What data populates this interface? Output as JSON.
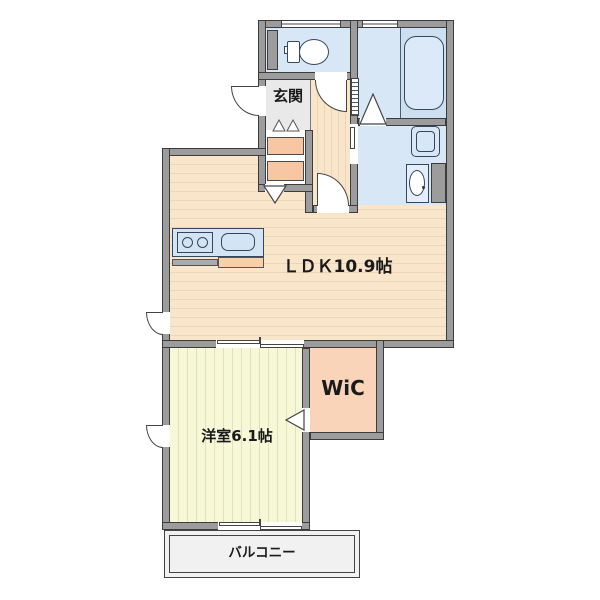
{
  "plan": {
    "type": "apartment-floor-plan",
    "labels": {
      "ldk": "ＬＤＫ10.9帖",
      "bedroom": "洋室6.1帖",
      "wic": "WiC",
      "genkan": "玄関",
      "balcony": "バルコニー"
    },
    "colors": {
      "wall": "#9c9c9c",
      "wall_outline": "#3c3c3c",
      "water_room_floor": "#d8e7f5",
      "tub_zone_floor": "#cde0f2",
      "ldk_floor": "#f9e5c9",
      "bedroom_floor": "#f7f8d8",
      "wic_floor": "#fad4b9",
      "genkan_floor": "#e9e9e9",
      "balcony_floor": "#f1f1f1",
      "closet": "#f6c7a2",
      "kitchen_counter": "#d3e4f5"
    },
    "icons": [
      "toilet-icon",
      "bathtub-icon",
      "washing-machine-pan-icon",
      "vanity-sink-icon",
      "stove-burner-icon",
      "kitchen-sink-icon",
      "door-swing-icon",
      "sliding-door-icon",
      "folding-door-icon",
      "casement-window-icon",
      "step-mark-icon"
    ]
  }
}
